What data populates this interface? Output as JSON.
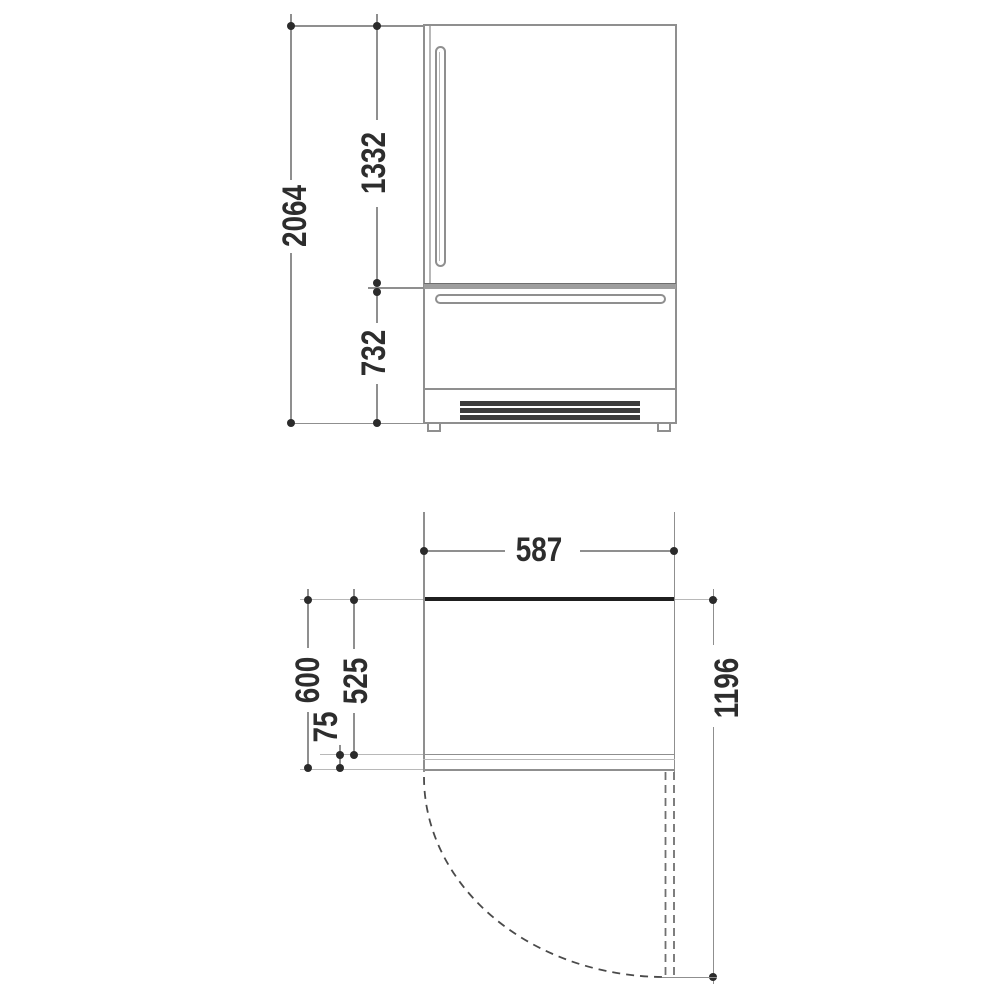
{
  "diagram": {
    "kind": "refrigerator installation dimension drawing",
    "units": "mm"
  },
  "dims": {
    "front": {
      "overall_height": "2064",
      "upper_door_height": "1332",
      "lower_section_height": "732"
    },
    "plan": {
      "width": "587",
      "total_depth": "600",
      "body_depth": "525",
      "door_thickness": "75",
      "open_door_clearance": "1196"
    }
  },
  "colors": {
    "line": "#8f8f8f",
    "thick_edge": "#1f1f1f",
    "grille": "#3c3c3c",
    "text": "#2d2d2d",
    "divider_fill": "#9e9e9e"
  }
}
